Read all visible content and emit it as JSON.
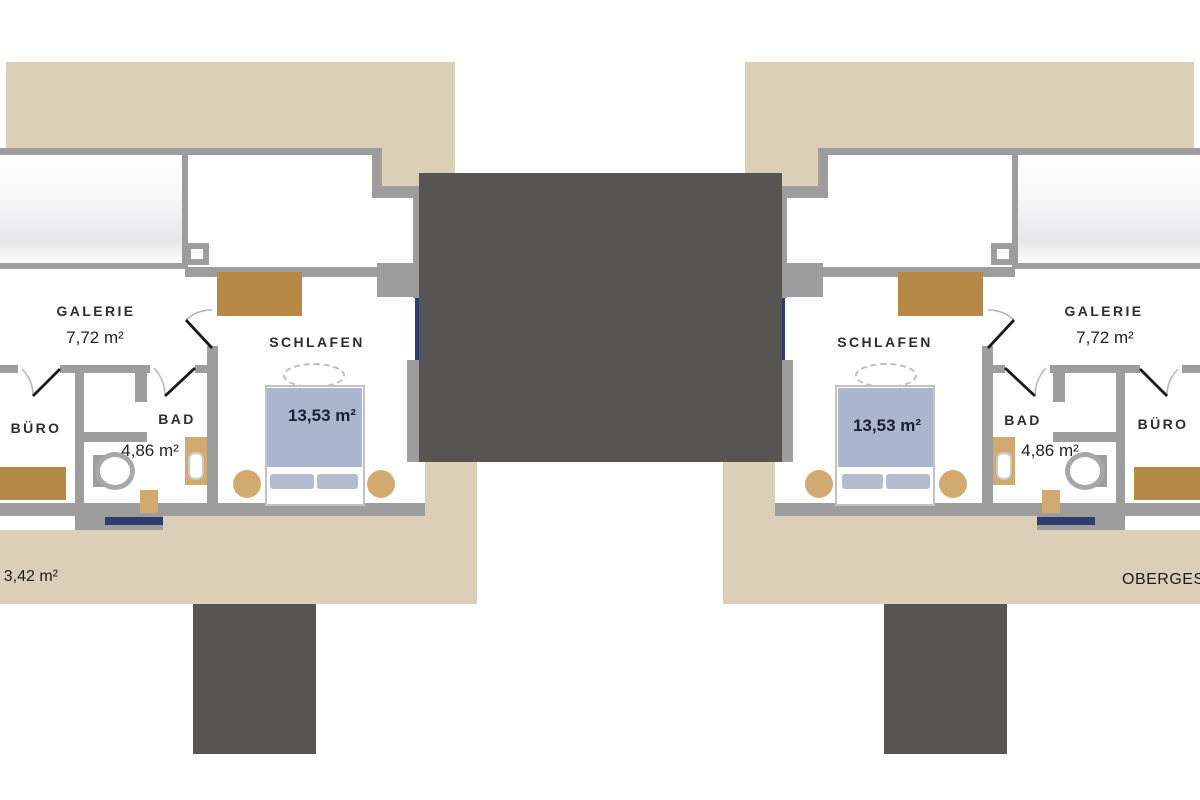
{
  "plan": {
    "type": "floor-plan",
    "floor_caption_left_partial": "3,42 m²",
    "floor_caption_right_partial": "OBERGES",
    "units": {
      "left": {
        "galerie_name": "GALERIE",
        "galerie_area": "7,72 m²",
        "schlafen_name": "SCHLAFEN",
        "schlafen_area": "13,53 m²",
        "bad_name": "BAD",
        "bad_area": "4,86 m²",
        "buero_name": "BÜRO"
      },
      "right": {
        "galerie_name": "GALERIE",
        "galerie_area": "7,72 m²",
        "schlafen_name": "SCHLAFEN",
        "schlafen_area": "13,53 m²",
        "bad_name": "BAD",
        "bad_area": "4,86 m²",
        "buero_name": "BÜRO"
      }
    },
    "colors": {
      "roof_beige": "#dccfb7",
      "wall_gray": "#9d9d9d",
      "dark_block": "#575553",
      "wood_brown": "#b68a46",
      "furniture_tan": "#d2aa70",
      "bed_blue": "#a9b6cd",
      "window_navy": "#2e3c6e"
    }
  }
}
